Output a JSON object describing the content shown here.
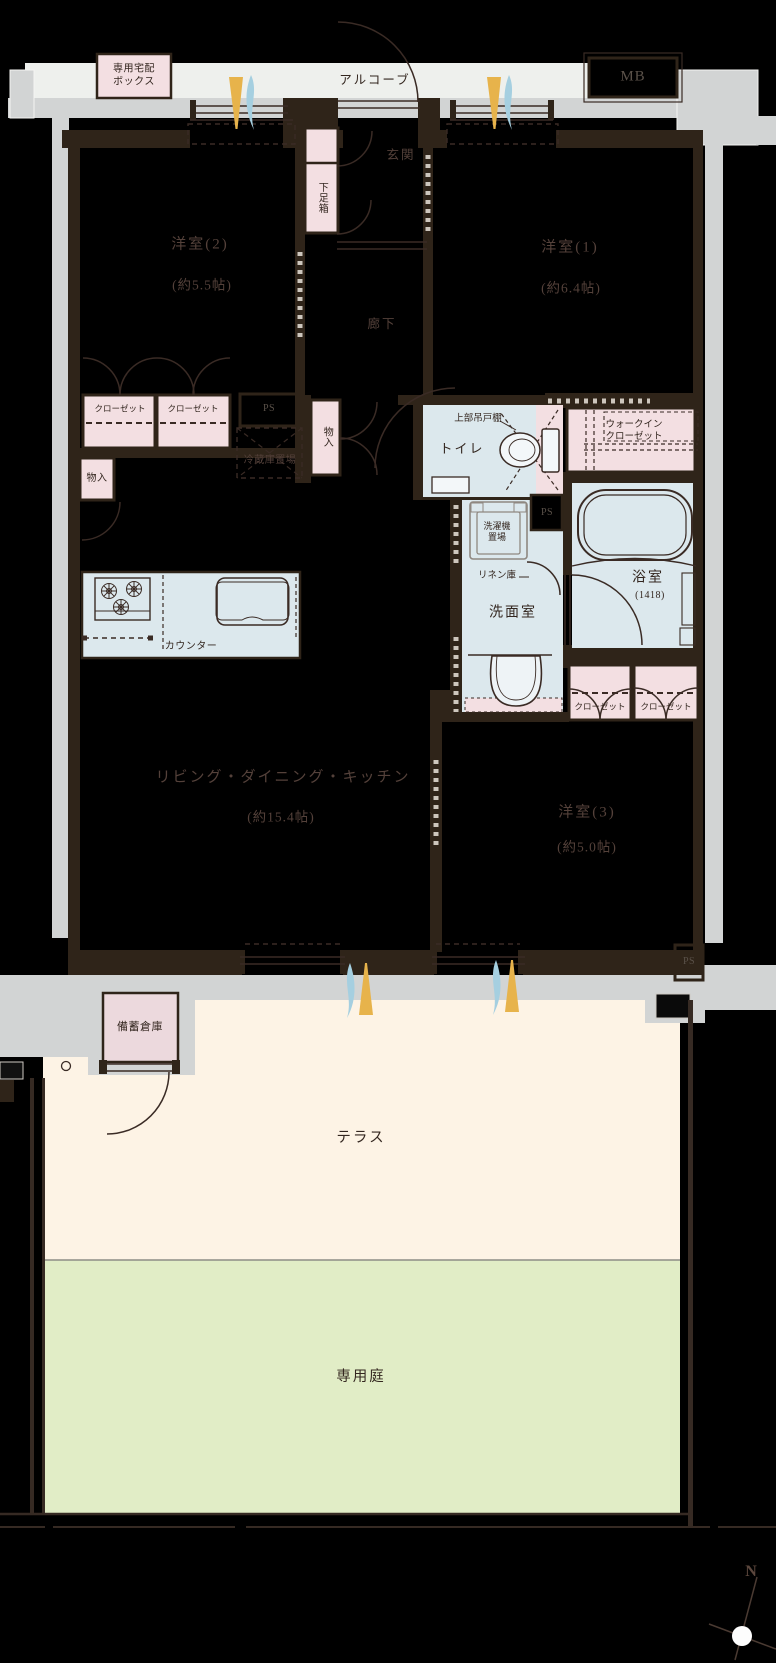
{
  "plan": {
    "alcove": "アルコーブ",
    "delivery_box_l1": "専用宅配",
    "delivery_box_l2": "ボックス",
    "mb": "MB",
    "entrance": "玄関",
    "shoe_box": "下足箱",
    "room2_name": "洋室(2)",
    "room2_size": "(約5.5帖)",
    "room1_name": "洋室(1)",
    "room1_size": "(約6.4帖)",
    "corridor": "廊下",
    "closet": "クローゼット",
    "ps": "PS",
    "storage": "物入",
    "refrigerator": "冷蔵庫置場",
    "toilet": "トイレ",
    "upper_cabinet": "上部吊戸棚",
    "wic_l1": "ウォークイン",
    "wic_l2": "クローゼット",
    "washer_l1": "洗濯機",
    "washer_l2": "置場",
    "linen": "リネン庫",
    "washroom": "洗面室",
    "bath_name": "浴室",
    "bath_size": "(1418)",
    "counter": "カウンター",
    "ldk_name": "リビング・ダイニング・キッチン",
    "ldk_size": "(約15.4帖)",
    "room3_name": "洋室(3)",
    "room3_size": "(約5.0帖)",
    "stockpile": "備蓄倉庫",
    "terrace": "テラス",
    "garden": "専用庭",
    "compass_n": "N"
  },
  "colors": {
    "room_fill_pink": "#f3dfe2",
    "room_fill_blue": "#dce8ed",
    "terrace_cream": "#fdf3e5",
    "garden_green": "#e1edc6",
    "concrete_gray": "#d2d4d4",
    "alcove_gray": "#eef0ed",
    "wall_dark": "#2f2419",
    "line_brown": "#3a2b25",
    "flame_gold": "#e7b34b",
    "flame_blue": "#a5cfe0"
  }
}
